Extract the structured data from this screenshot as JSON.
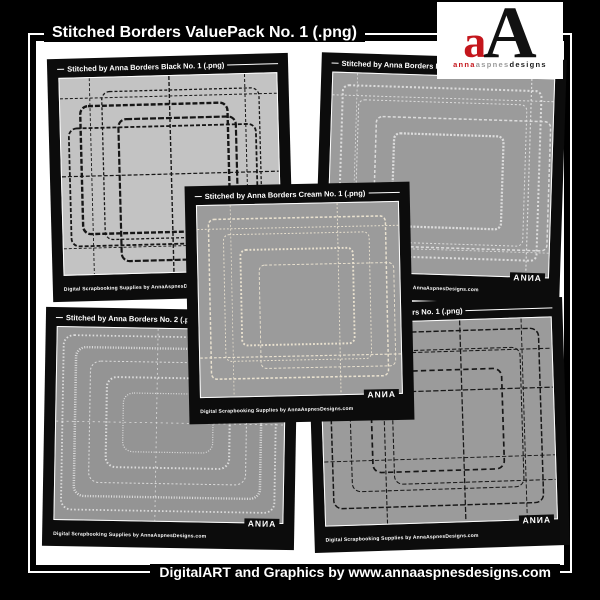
{
  "page": {
    "title": "Stitched Borders ValuePack No. 1 (.png)",
    "footer_credit": "DigitalART and Graphics by www.annaaspnesdesigns.com"
  },
  "logo": {
    "letter_small": "a",
    "letter_large": "A",
    "subtext_anna": "anna",
    "subtext_aspnes": "aspnes",
    "subtext_designs": "designs"
  },
  "colors": {
    "page_background": "#000000",
    "content_background": "#ffffff",
    "card_background": "#0c0c0c",
    "logo_red": "#c4161c",
    "swatch_light": "#c3c3c3",
    "swatch_gray": "#9b9b9b",
    "stitch_dark": "#161616",
    "stitch_light": "#dcdcdc",
    "stitch_cream": "#e9e1cf"
  },
  "cards": [
    {
      "title": "Stitched by Anna Borders Black No. 1 (.png)",
      "credit": "Digital Scrapbooking Supplies by AnnaAspnesDesigns.com",
      "brand": "ANИA"
    },
    {
      "title": "Stitched by Anna Borders No. 3 (.png)",
      "credit": "Digital Scrapbooking Supplies by AnnaAspnesDesigns.com",
      "brand": "ANИA"
    },
    {
      "title": "Stitched by Anna Borders Cream No. 1 (.png)",
      "credit": "Digital Scrapbooking Supplies by AnnaAspnesDesigns.com",
      "brand": "ANИA"
    },
    {
      "title": "Stitched by Anna Borders No. 2 (.png)",
      "credit": "Digital Scrapbooking Supplies by AnnaAspnesDesigns.com",
      "brand": "ANИA"
    },
    {
      "title": "Stitched by Anna Borders No. 1 (.png)",
      "credit": "Digital Scrapbooking Supplies by AnnaAspnesDesigns.com",
      "brand": "ANИA"
    }
  ]
}
